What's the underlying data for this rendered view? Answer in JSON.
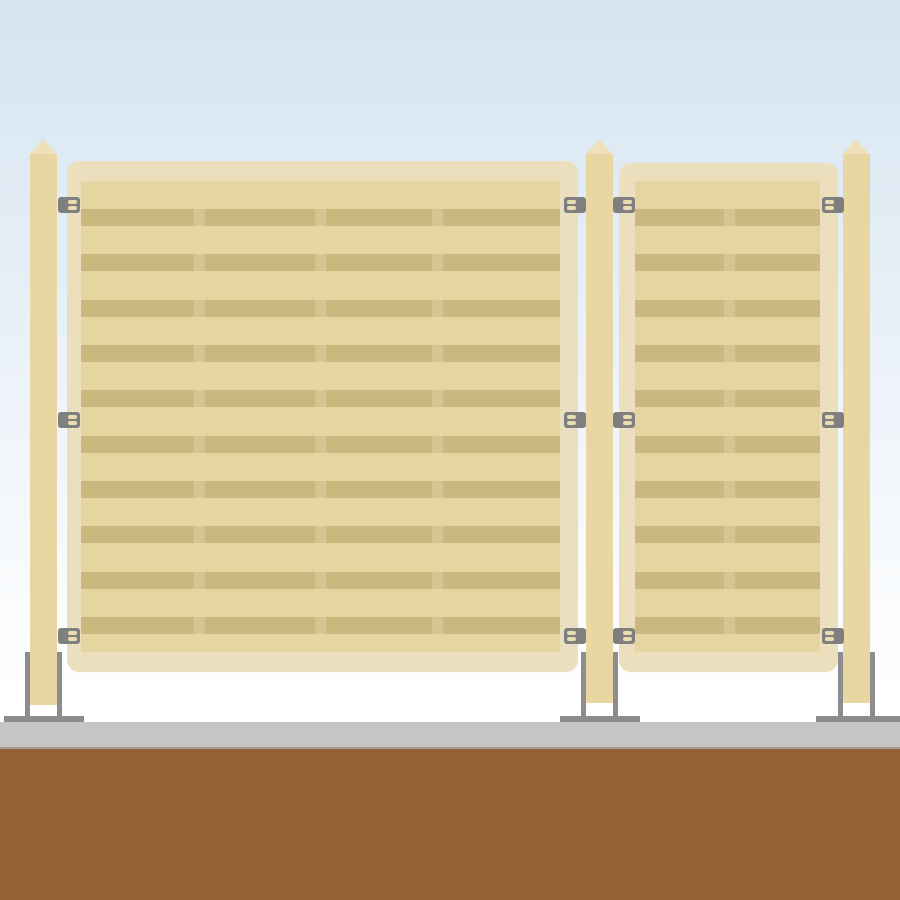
{
  "scene": {
    "title": "Flat illustration of a slatted privacy fence: two louvered panels fixed between three capped posts, bolted to a concrete footing over soil",
    "colors": {
      "sky_top": "#d5e4f1",
      "sky_bottom": "#ffffff",
      "post": "#e8d7a3",
      "post_cap": "#eee1ba",
      "panel_frame": "#ecdfbd",
      "panel_inner": "#e5d5a1",
      "slat": "#cbb87e",
      "slat_divider": "#d6c492",
      "bracket": "#7f7f7f",
      "bracket_slot": "#e9ddb0",
      "hardware": "#8d8d8d",
      "concrete": "#c7c5c4",
      "concrete_edge": "#a79b8f",
      "soil": "#966236"
    },
    "post_cap_top": 139,
    "post_body_top": 154,
    "posts": [
      {
        "x": 30,
        "width": 27,
        "bottom": 705
      },
      {
        "x": 586,
        "width": 27,
        "bottom": 703
      },
      {
        "x": 843,
        "width": 27,
        "bottom": 703
      }
    ],
    "anchor": {
      "plate_y": 716,
      "plate_height": 6,
      "rod_top": 652,
      "rod_bottom": 717,
      "rod_width": 5
    },
    "anchors": [
      {
        "plate_x": 4,
        "plate_width": 80,
        "rods": [
          25,
          57
        ]
      },
      {
        "plate_x": 560,
        "plate_width": 80,
        "rods": [
          581,
          613
        ]
      },
      {
        "plate_x": 816,
        "plate_width": 84,
        "rods": [
          838,
          870
        ]
      }
    ],
    "panels": [
      {
        "name": "left-panel",
        "x": 67,
        "y": 161,
        "width": 511,
        "height": 511,
        "inner": {
          "left": 14,
          "top": 20,
          "width": 479,
          "height": 471
        },
        "rows": {
          "count": 10,
          "start": 28,
          "pitch": 45.33,
          "height": 17
        },
        "columns": {
          "gap": 11,
          "flex": [
            113,
            110,
            106,
            117
          ]
        }
      },
      {
        "name": "right-panel",
        "x": 619,
        "y": 163,
        "width": 219,
        "height": 509,
        "inner": {
          "left": 16,
          "top": 18,
          "width": 185,
          "height": 471
        },
        "rows": {
          "count": 10,
          "start": 28,
          "pitch": 45.33,
          "height": 17
        },
        "columns": {
          "gap": 11,
          "flex": [
            90,
            85
          ]
        }
      }
    ],
    "brackets": {
      "rows_y": [
        197,
        412,
        628
      ],
      "width": 22,
      "height": 16,
      "items": [
        {
          "x": 58,
          "slots": "right"
        },
        {
          "x": 564,
          "slots": "left"
        },
        {
          "x": 613,
          "slots": "right"
        },
        {
          "x": 822,
          "slots": "left"
        }
      ]
    }
  }
}
